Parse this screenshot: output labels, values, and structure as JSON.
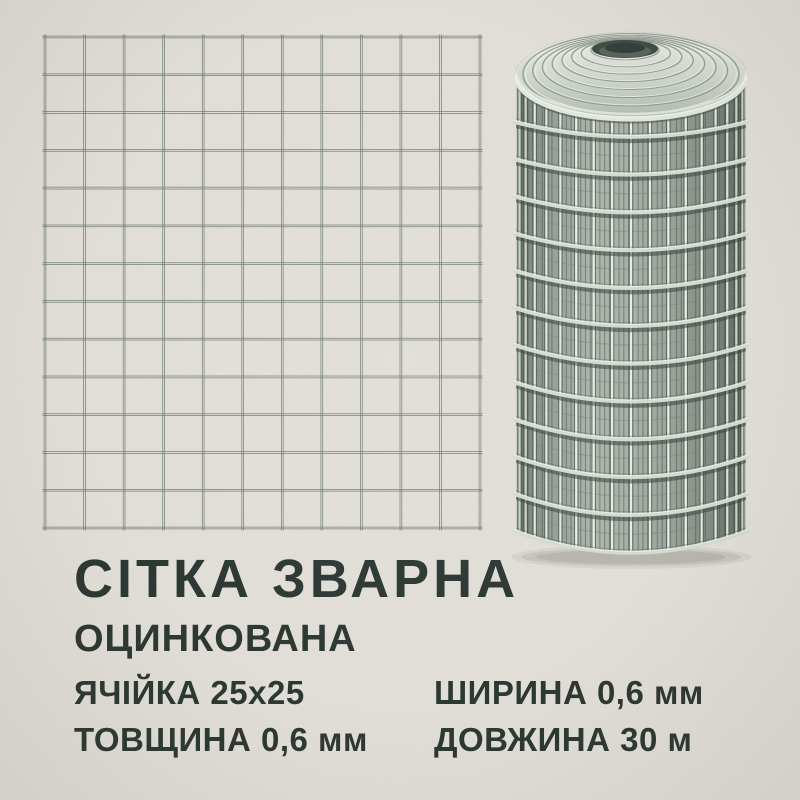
{
  "theme": {
    "background": "#e3e0d9",
    "ink": "#2a3631",
    "grid_wire": "#6f7a74",
    "metal_highlight": "#f2f5ef",
    "metal_light": "#d6dcd2",
    "metal_mid": "#a7b1a7",
    "metal_dark": "#414c46",
    "metal_shadow": "#37423c"
  },
  "banner": {
    "title": "СІТКА ЗВАРНА",
    "subtitle": "ОЦИНКОВАНА",
    "specs": [
      {
        "id": "cell-size",
        "text": "ЯЧІЙКА 25х25"
      },
      {
        "id": "width",
        "text": "ШИРИНА 0,6 мм"
      },
      {
        "id": "thickness",
        "text": "ТОВЩИНА 0,6 мм"
      },
      {
        "id": "length",
        "text": "ДОВЖИНА 30 м"
      }
    ]
  },
  "illustrations": {
    "mesh_grid": {
      "name": "welded-mesh-grid-drawing",
      "columns": 11,
      "rows": 13
    },
    "mesh_roll": {
      "name": "welded-mesh-roll-render",
      "body_rings": 12,
      "front_wires": 19,
      "coil_rings": 8,
      "inner_lines": 48
    }
  }
}
